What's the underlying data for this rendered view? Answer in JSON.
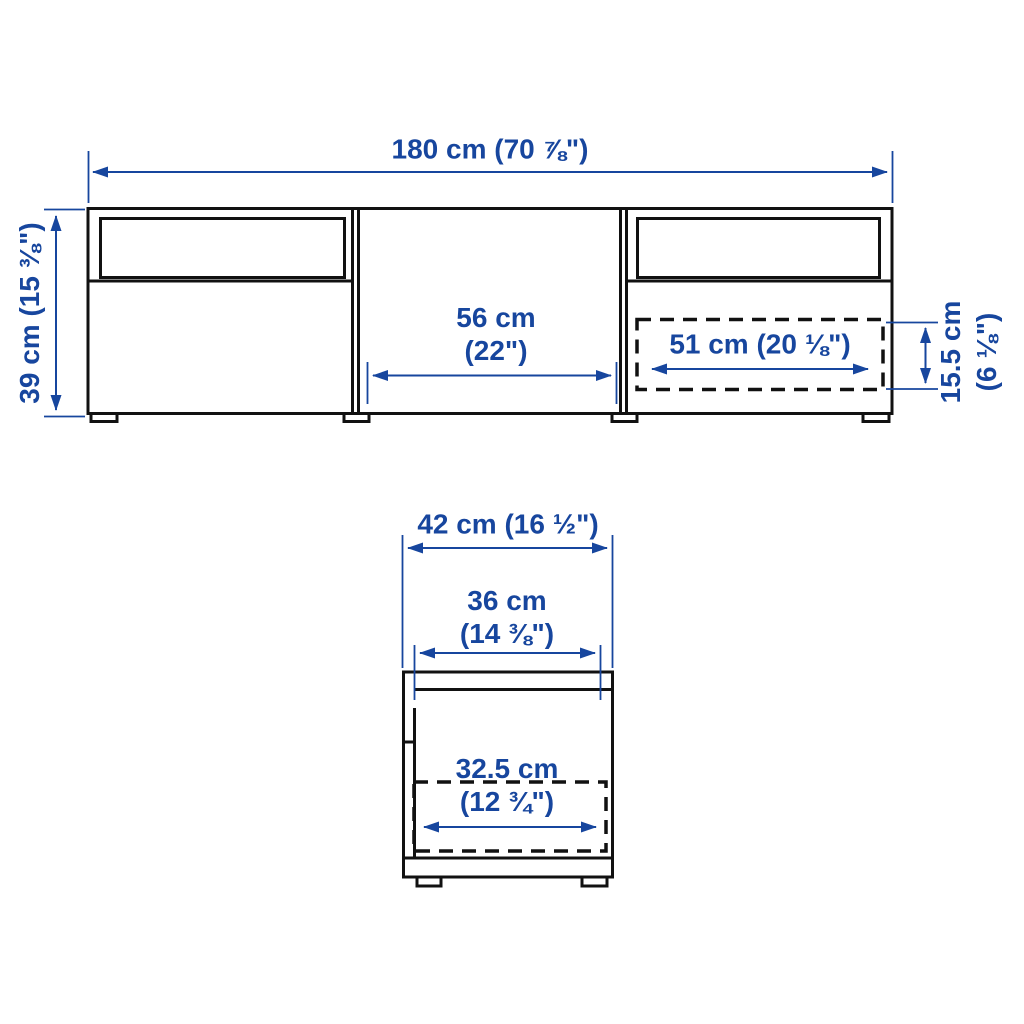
{
  "title": "TV bench dimension diagram",
  "colors": {
    "dimension_blue": "#17469e",
    "line_black": "#111111",
    "background": "#ffffff"
  },
  "front_view": {
    "overall_width": "180 cm (70 ⅞\")",
    "overall_height": "39 cm (15 ⅜\")",
    "center_compartment_width_line1": "56 cm",
    "center_compartment_width_line2": "(22\")",
    "drawer_interior_width": "51 cm (20 ⅛\")",
    "drawer_interior_height_line1": "15.5 cm",
    "drawer_interior_height_line2": "(6 ⅛\")"
  },
  "side_view": {
    "overall_depth": "42 cm (16 ½\")",
    "interior_depth_line1": "36 cm",
    "interior_depth_line2": "(14 ⅜\")",
    "drawer_interior_depth_line1": "32.5 cm",
    "drawer_interior_depth_line2": "(12 ¾\")"
  }
}
